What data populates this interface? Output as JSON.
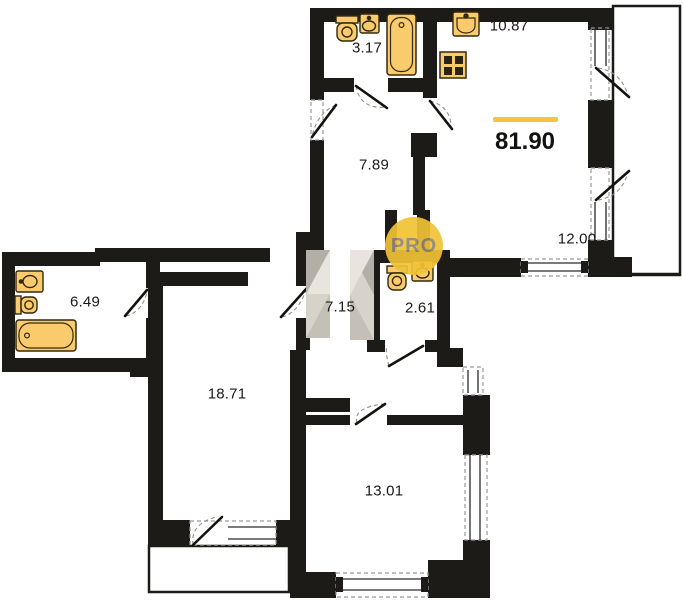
{
  "plan": {
    "title": "apartment-floor-plan",
    "total": {
      "value": "81.90",
      "accent_color": "#F5C243"
    },
    "rooms": [
      {
        "name": "bathroom-top",
        "area": "3.17"
      },
      {
        "name": "kitchen",
        "area": "10.87"
      },
      {
        "name": "hallway",
        "area": "7.89"
      },
      {
        "name": "living-room",
        "area": "12.00"
      },
      {
        "name": "bathroom-left",
        "area": "6.49"
      },
      {
        "name": "corridor",
        "area": "7.15"
      },
      {
        "name": "wc",
        "area": "2.61"
      },
      {
        "name": "bedroom-1",
        "area": "18.71"
      },
      {
        "name": "bedroom-2",
        "area": "13.01"
      }
    ],
    "watermark": {
      "text": "PRO",
      "circle_color": "#F1C337",
      "text_color": "#8E867A"
    },
    "colors": {
      "wall": "#1d1b18",
      "fixture_fill": "#F9CB6C",
      "fixture_stroke": "#33290f",
      "wardrobe": "#d7d2ca",
      "dash": "#9a9a9a"
    }
  }
}
